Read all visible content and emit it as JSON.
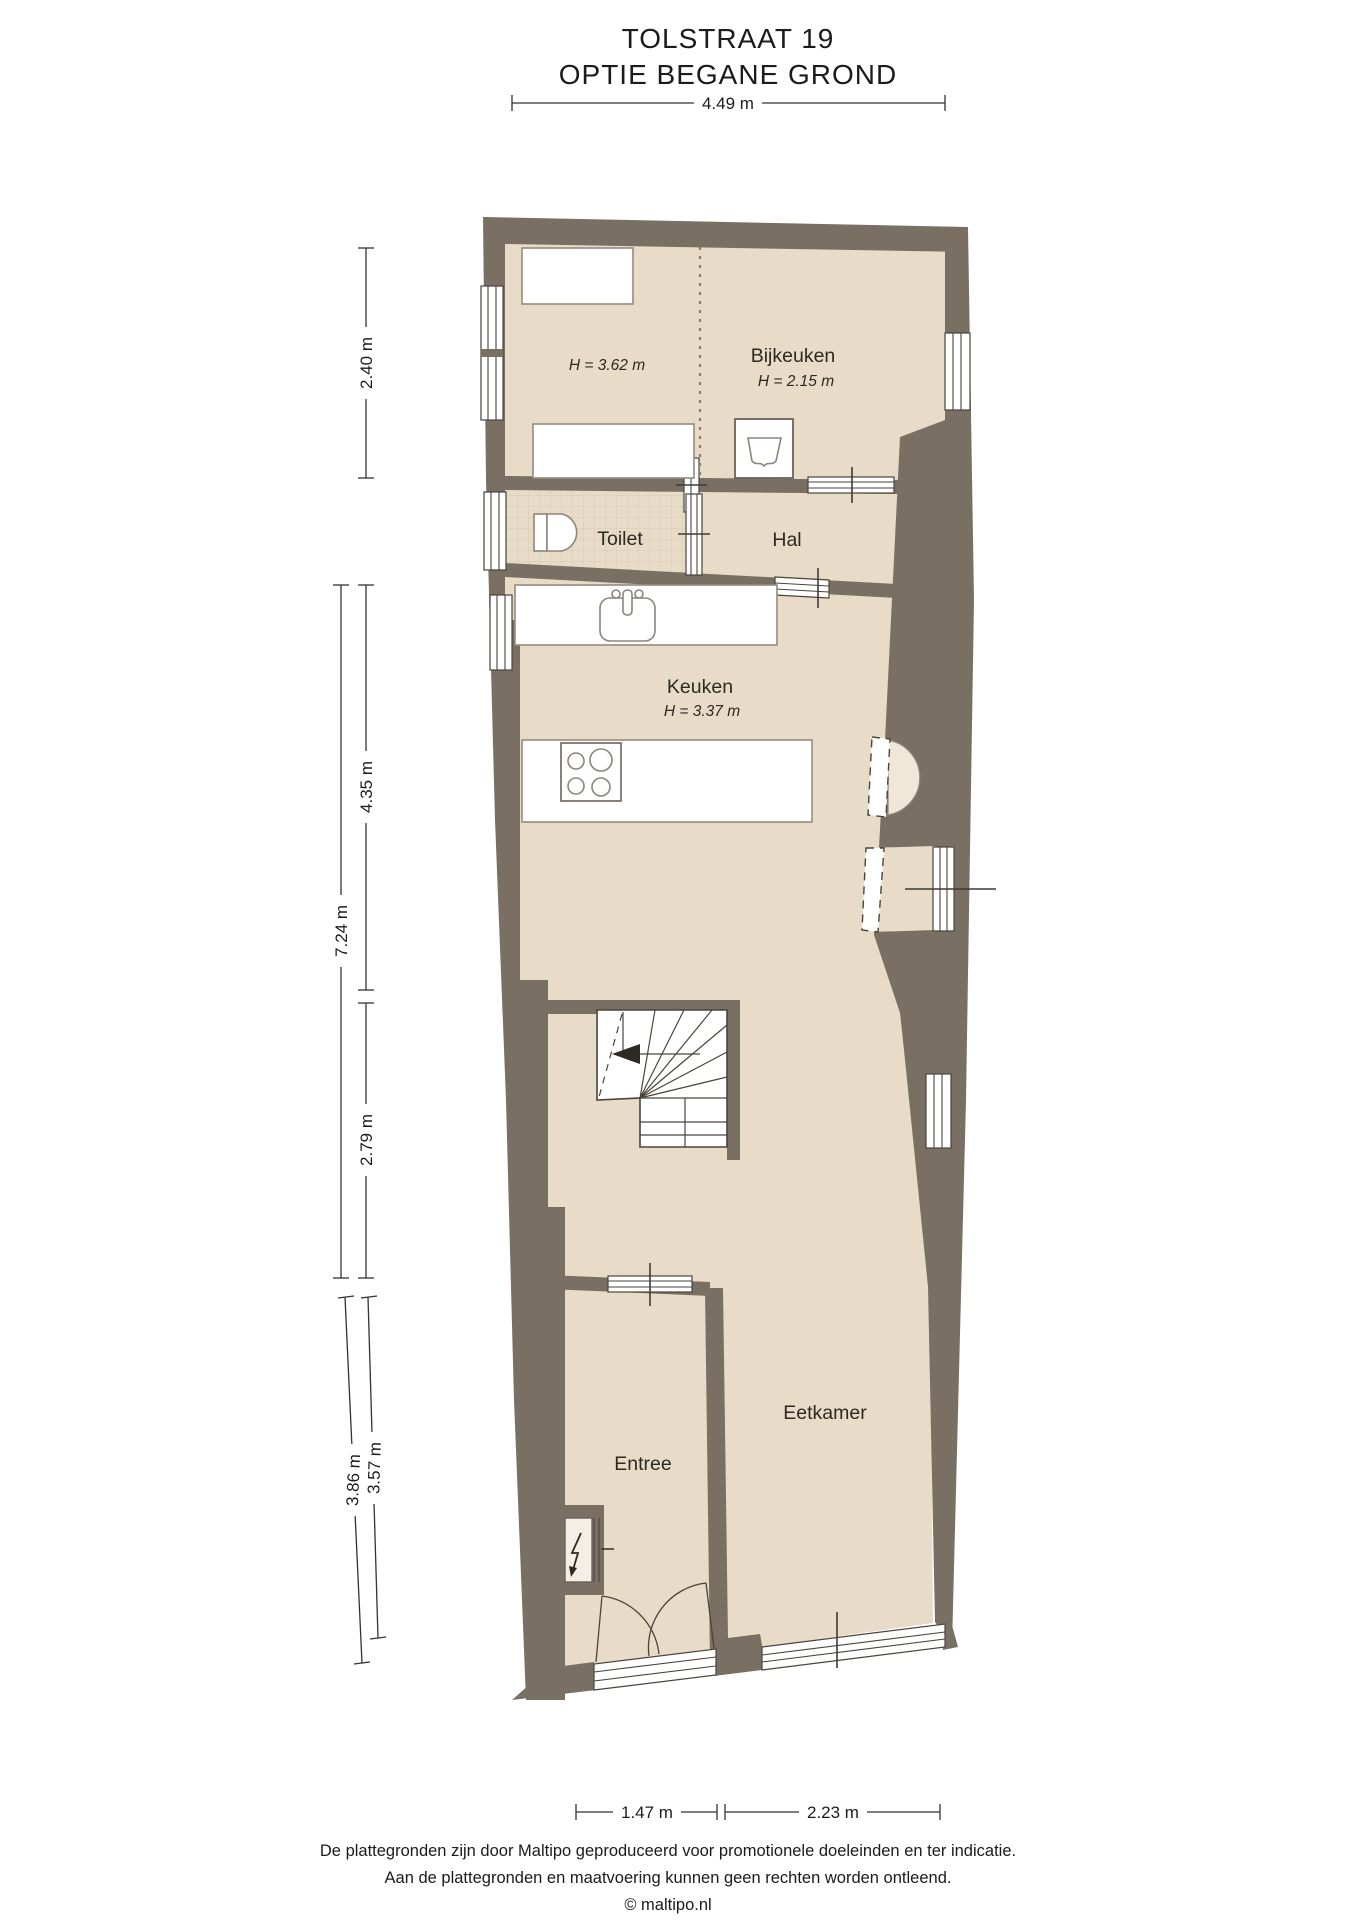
{
  "header": {
    "title": "TOLSTRAAT 19",
    "subtitle": "OPTIE BEGANE GROND"
  },
  "dimensions": {
    "top_width": "4.49 m",
    "left_top": "2.40 m",
    "left_total": "7.24 m",
    "left_mid_upper": "4.35 m",
    "left_mid_lower": "2.79 m",
    "left_bottom_outer": "3.86 m",
    "left_bottom_inner": "3.57 m",
    "bottom_left": "1.47 m",
    "bottom_right": "2.23 m"
  },
  "rooms": {
    "scullery_left": {
      "height": "H = 3.62 m"
    },
    "bijkeuken": {
      "name": "Bijkeuken",
      "height": "H = 2.15 m"
    },
    "toilet": {
      "name": "Toilet"
    },
    "hal": {
      "name": "Hal"
    },
    "keuken": {
      "name": "Keuken",
      "height": "H = 3.37 m"
    },
    "eetkamer": {
      "name": "Eetkamer"
    },
    "entree": {
      "name": "Entree"
    }
  },
  "footer": {
    "line1": "De plattegronden zijn door Maltipo geproduceerd voor promotionele doeleinden en ter indicatie.",
    "line2": "Aan de plattegronden en maatvoering kunnen geen rechten worden ontleend.",
    "line3": "© maltipo.nl"
  },
  "colors": {
    "wall": "#7a6f63",
    "floor": "#e8dbc8",
    "tile_line": "#d8c8b2",
    "niche": "#f0e7d8",
    "symbol_line": "#4a443c"
  }
}
